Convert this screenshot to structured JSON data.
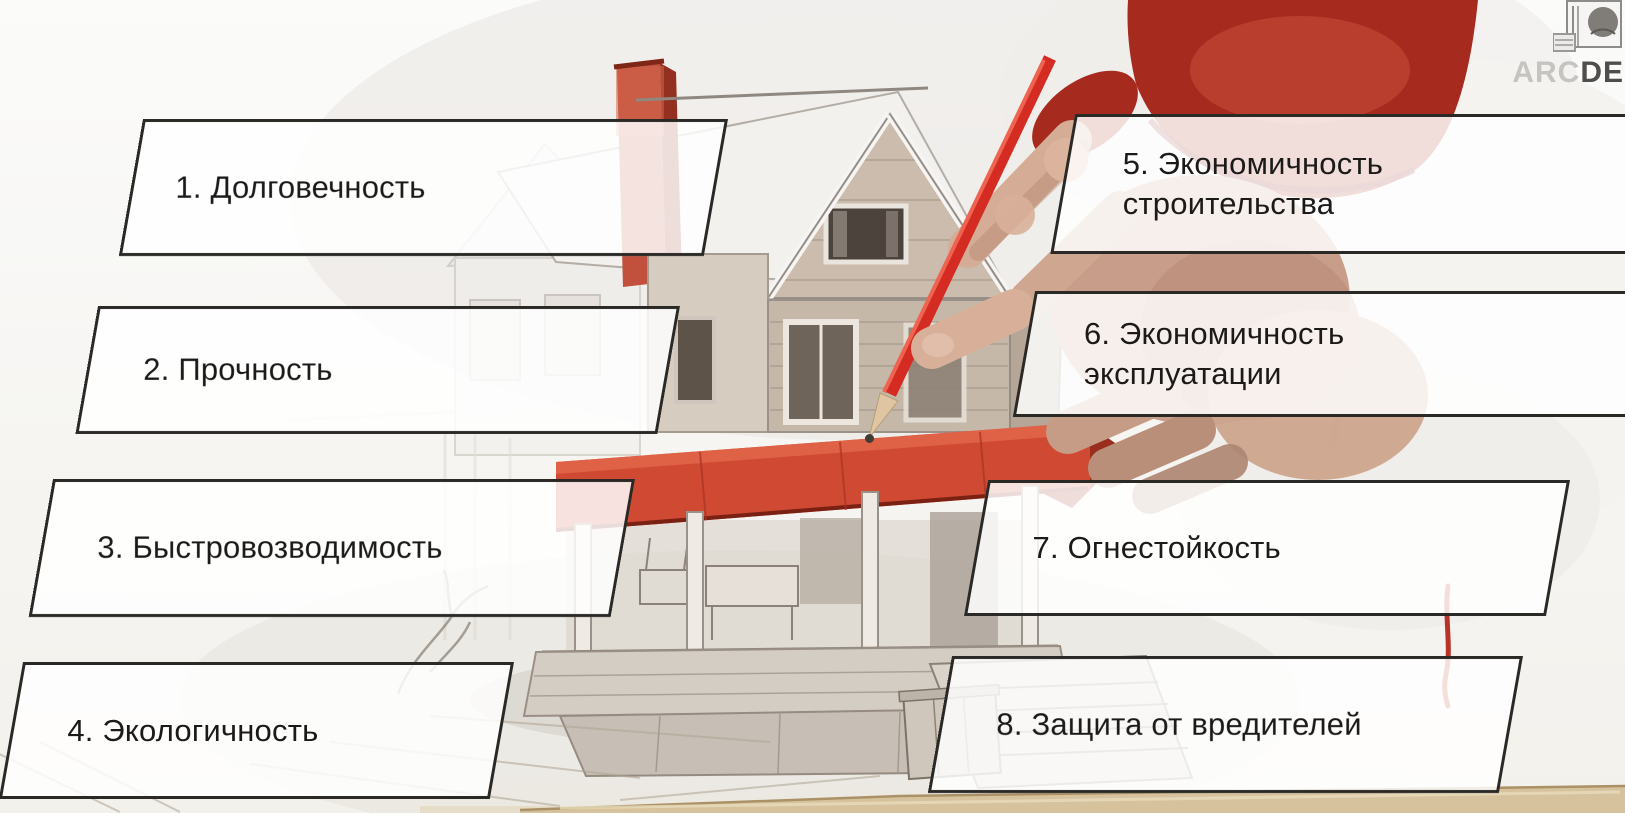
{
  "slide": {
    "background": "#f7f6f3",
    "labels": [
      {
        "name": "durability",
        "text": "1. Долговечность"
      },
      {
        "name": "strength",
        "text": "2. Прочность"
      },
      {
        "name": "quick-assembly",
        "text": "3. Быстровозводимость"
      },
      {
        "name": "eco-friendliness",
        "text": "4. Экологичность"
      },
      {
        "name": "construction-economy",
        "text": "5. Экономичность\nстроительства"
      },
      {
        "name": "operation-economy",
        "text": "6. Экономичность\nэксплуатации"
      },
      {
        "name": "fire-resistance",
        "text": "7. Огнестойкость"
      },
      {
        "name": "pest-protection",
        "text": "8. Защита от вредителей"
      }
    ],
    "logo": {
      "prefix": "ARC",
      "suffix": "DE"
    },
    "colors": {
      "accent_red": "#c23b2a",
      "awning_red": "#d04a33",
      "pencil_red": "#d42b22",
      "plate_border": "#2b2926",
      "text": "#1c1a18"
    }
  }
}
